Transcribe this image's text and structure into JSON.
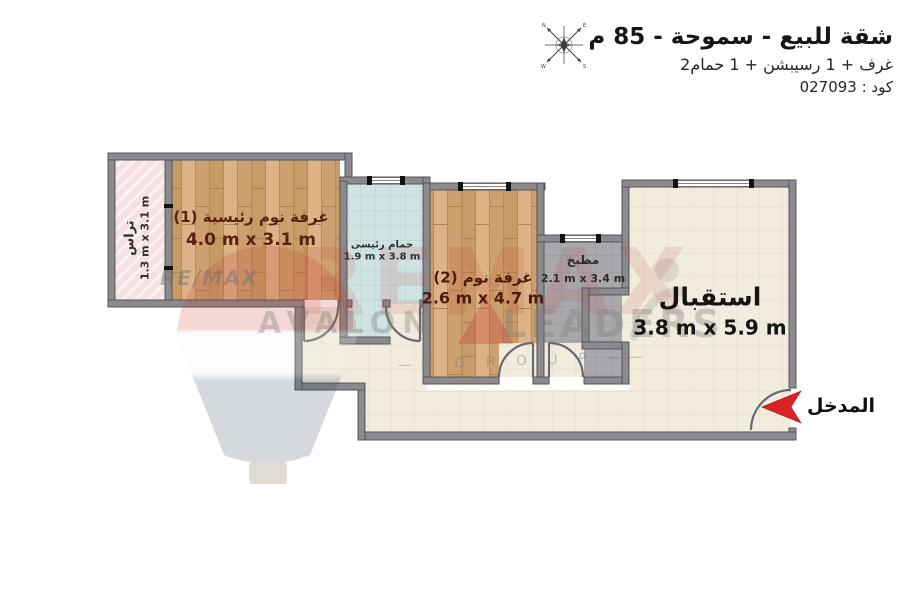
{
  "header": {
    "title": "شقة للبيع - سموحة - 85 م",
    "subtitle": "2غرف + 1 رسيبشن + 1 حمام",
    "code": "كود : 027093"
  },
  "rooms": {
    "terrace": {
      "name": "تراس",
      "dims": "1.3 m x 3.1 m"
    },
    "master": {
      "name": "غرفة نوم رئيسية (1)",
      "dims": "4.0 m x 3.1 m"
    },
    "bathroom": {
      "name": "حمام رئيسى",
      "dims": "1.9 m x 3.8 m"
    },
    "bedroom2": {
      "name": "غرفة نوم (2)",
      "dims": "2.6 m x 4.7 m"
    },
    "kitchen": {
      "name": "مطبخ",
      "dims": "2.1 m x 3.4 m"
    },
    "reception": {
      "name": "استقبال",
      "dims": "3.8 m x 5.9 m"
    }
  },
  "entrance": {
    "label": "المدخل"
  },
  "watermark": {
    "big": "REMAX",
    "remax": "RE/MAX",
    "avalon": "AVALON",
    "leaders": "LEADERS",
    "group": "—— G R O U P ——"
  },
  "colors": {
    "wall": "#8b8b8f",
    "wood_floor": "#d4a976",
    "bathroom_floor": "#cfe4e2",
    "kitchen_floor": "#a9a9ad",
    "hall_floor": "#f1ecde",
    "terrace_floor": "#f7e0e1",
    "bedroom_label": "#5a2110",
    "accent_red": "#d9232a"
  }
}
